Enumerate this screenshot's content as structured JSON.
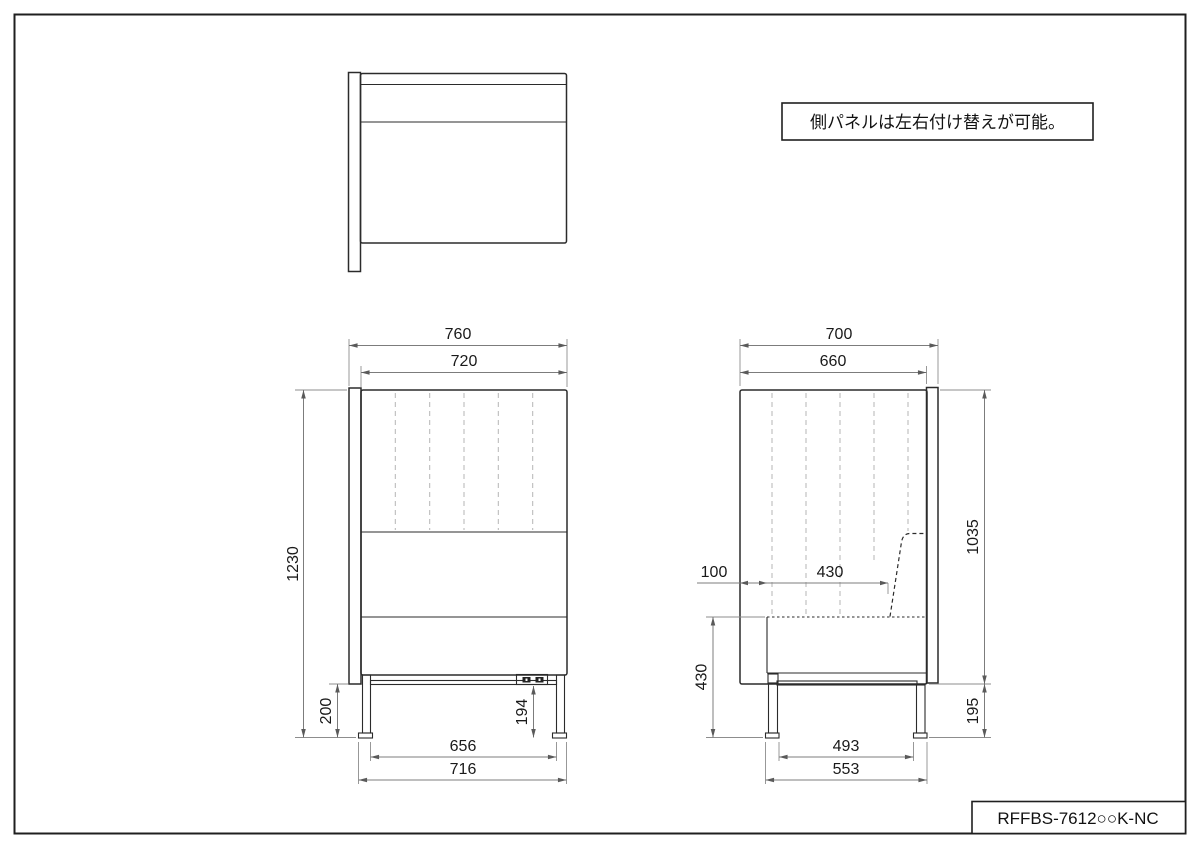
{
  "drawing": {
    "note": "側パネルは左右付け替えが可能。",
    "part_number": "RFFBS-7612○○K-NC",
    "front_view": {
      "width_total": "760",
      "width_body": "720",
      "height_total": "1230",
      "panel_ground_clearance": "200",
      "outlet_height": "194",
      "leg_span_inner": "656",
      "leg_span_outer": "716"
    },
    "side_view": {
      "depth_total": "700",
      "depth_body": "660",
      "panel_height": "1035",
      "seat_front_offset": "100",
      "seat_depth": "430",
      "seat_height": "430",
      "panel_clearance": "195",
      "leg_span_inner": "493",
      "leg_span_outer": "553"
    }
  }
}
